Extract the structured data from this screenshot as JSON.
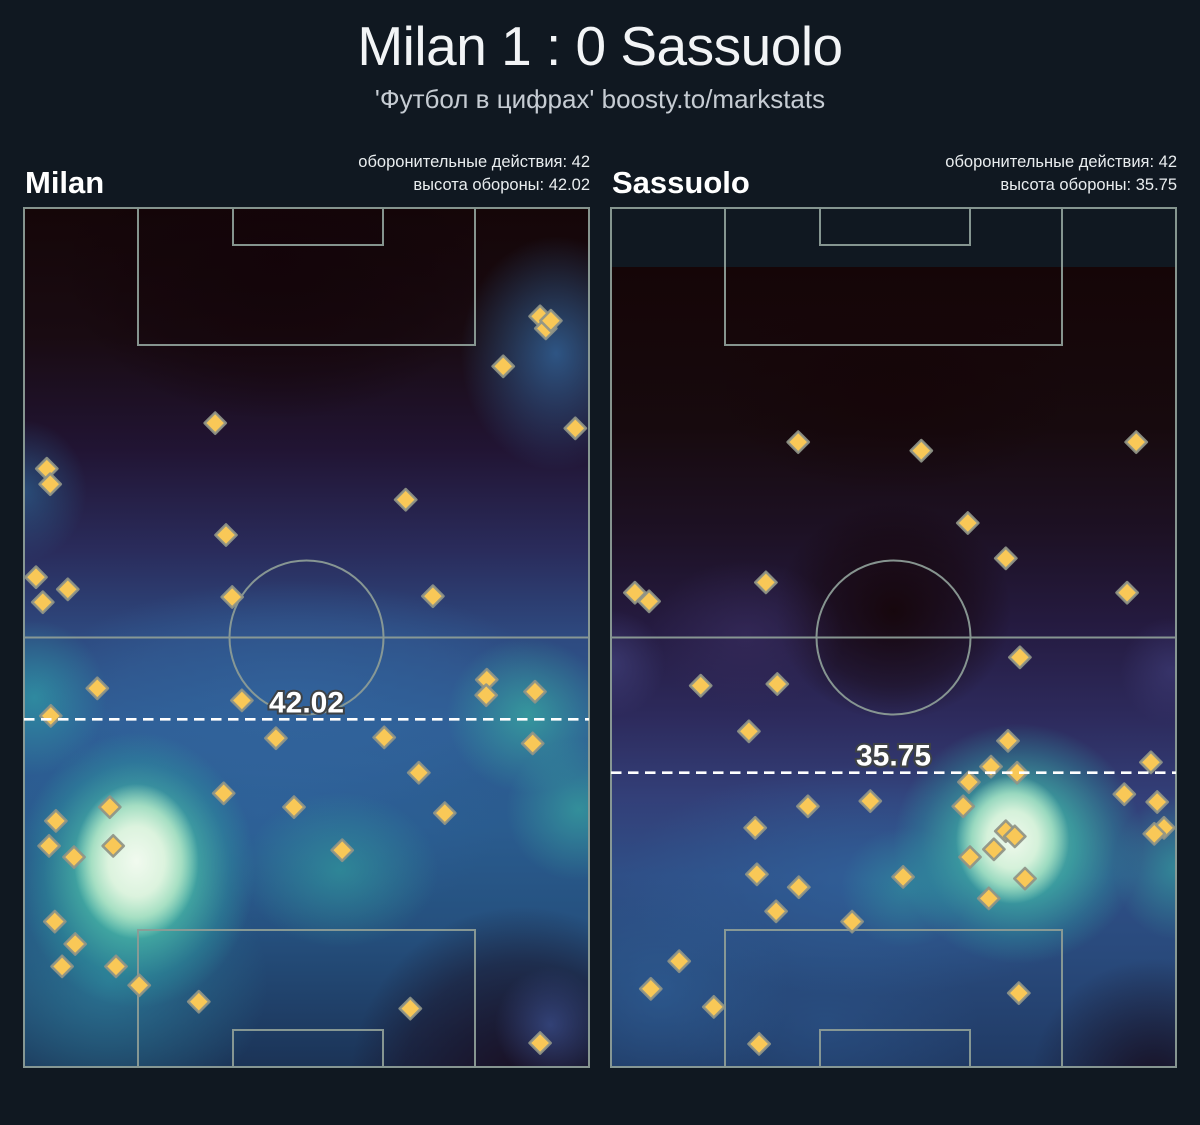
{
  "page": {
    "background": "#101821",
    "title": "Milan 1 : 0 Sassuolo",
    "subtitle": "'Футбол в цифрах' boosty.to/markstats"
  },
  "style": {
    "line_color": "#8c9c96",
    "marker_fill": "#f9c857",
    "marker_stroke": "#8e9488",
    "dash_color": "#ffffff",
    "label_fill": "#ffffff",
    "label_outline": "#3e4245",
    "title_color": "#f2f4f6",
    "subtitle_color": "#c6ccd3",
    "stat_text_color": "#e9edef"
  },
  "chart_data": {
    "type": "scatter",
    "overlay": "kde-heatmap",
    "title": "Milan 1 : 0 Sassuolo",
    "subtitle": "'Футбол в цифрах' boosty.to/markstats",
    "units": "marker coords are percent of pitch box; x: 0=left touchline, 100=right; y: 0=attacking goal line, 100=own goal line",
    "pitch_geometry": {
      "width_px": 567,
      "height_px": 861,
      "penalty_box": {
        "x": 115,
        "w": 337,
        "d": 137
      },
      "goal_box": {
        "x": 210,
        "w": 150,
        "d": 37
      },
      "circle_r": 77
    },
    "pitches": [
      {
        "team": "Milan",
        "defensive_actions": 42,
        "defense_height": 42.02,
        "stat1": "оборонительные действия: 42",
        "stat2": "высота обороны: 42.02",
        "defense_line_label": "42.02",
        "defense_line_y_pct": 59.5,
        "heat_top_px": 0,
        "markers_pct": [
          [
            91.2,
            12.7
          ],
          [
            92.2,
            14.1
          ],
          [
            93.1,
            13.2
          ],
          [
            84.7,
            18.5
          ],
          [
            33.9,
            25.1
          ],
          [
            97.4,
            25.7
          ],
          [
            4.2,
            30.4
          ],
          [
            4.8,
            32.2
          ],
          [
            67.5,
            34.0
          ],
          [
            35.8,
            38.1
          ],
          [
            2.3,
            43.0
          ],
          [
            7.9,
            44.4
          ],
          [
            3.5,
            45.9
          ],
          [
            36.9,
            45.3
          ],
          [
            72.3,
            45.2
          ],
          [
            13.1,
            55.9
          ],
          [
            81.8,
            54.9
          ],
          [
            81.7,
            56.7
          ],
          [
            90.3,
            56.3
          ],
          [
            38.6,
            57.3
          ],
          [
            4.9,
            59.1
          ],
          [
            44.6,
            61.7
          ],
          [
            63.7,
            61.6
          ],
          [
            89.9,
            62.3
          ],
          [
            69.8,
            65.7
          ],
          [
            15.3,
            69.7
          ],
          [
            5.8,
            71.3
          ],
          [
            4.6,
            74.2
          ],
          [
            9.0,
            75.5
          ],
          [
            15.9,
            74.2
          ],
          [
            35.4,
            68.1
          ],
          [
            47.8,
            69.7
          ],
          [
            56.3,
            74.7
          ],
          [
            74.4,
            70.4
          ],
          [
            5.6,
            83.0
          ],
          [
            9.2,
            85.6
          ],
          [
            6.9,
            88.2
          ],
          [
            16.4,
            88.2
          ],
          [
            20.5,
            90.4
          ],
          [
            31.0,
            92.3
          ],
          [
            68.3,
            93.1
          ],
          [
            91.2,
            97.1
          ]
        ],
        "heat": {
          "base": [
            "#150608 0%",
            "#190b12 15%",
            "#211433 28%",
            "#2a2c5c 40%",
            "#2e4a80 50%",
            "#2e5d94 60%",
            "#2a5c8f 72%",
            "#25507e 84%",
            "#1f3e66 94%",
            "#1b3356 100%"
          ],
          "blobs": [
            {
              "size": "11% 9%",
              "at": "20% 76%",
              "stops": [
                "#f1faef 0%",
                "#dcf3de 45%",
                "#b5e7c8d9 72%",
                "#b5e7c800 100%"
              ]
            },
            {
              "size": "21% 16%",
              "at": "20% 77%",
              "stops": [
                "#8edcba 0%",
                "#4abca8cc 45%",
                "#2f9aa066 78%",
                "#2f9aa000 100%"
              ]
            },
            {
              "size": "17% 12%",
              "at": "2% 57%",
              "stops": [
                "#2f96a4cc 0%",
                "#2f96a400 75%"
              ]
            },
            {
              "size": "36% 21%",
              "at": "15% 90%",
              "stops": [
                "#2e86a0b3 0%",
                "#2e86a000 78%"
              ]
            },
            {
              "size": "23% 12%",
              "at": "56% 77%",
              "stops": [
                "#30989bb3 0%",
                "#30989b00 75%"
              ]
            },
            {
              "size": "19% 12%",
              "at": "89% 59%",
              "stops": [
                "#38aaa0bf 0%",
                "#38aaa000 75%"
              ]
            },
            {
              "size": "17% 11%",
              "at": "98% 70%",
              "stops": [
                "#38aaa0a6 0%",
                "#38aaa000 75%"
              ]
            },
            {
              "size": "21% 17%",
              "at": "94% 17%",
              "stops": [
                "#33679fcc 0%",
                "#33679f00 80%"
              ]
            },
            {
              "size": "15% 11%",
              "at": "0% 33%",
              "stops": [
                "#2d6d9c99 0%",
                "#2d6d9c00 75%"
              ]
            },
            {
              "size": "55% 16%",
              "at": "48% 57%",
              "stops": [
                "#33669fb3 0%",
                "#33669f59 55%",
                "#33669f00 85%"
              ]
            },
            {
              "size": "50% 18%",
              "at": "42% 70%",
              "stops": [
                "#2f639bb3 0%",
                "#2f639b00 85%"
              ]
            },
            {
              "size": "13% 9%",
              "at": "93% 95%",
              "stops": [
                "#3c5191b3 0%",
                "#3c519100 75%"
              ]
            },
            {
              "size": "38% 26%",
              "at": "88% 102%",
              "stops": [
                "#190d20f2 0%",
                "#190d2073 55%",
                "#190d2000 80%"
              ]
            },
            {
              "size": "45% 22%",
              "at": "45% 6%",
              "stops": [
                "#130409e6 0%",
                "#13040966 60%",
                "#13040900 85%"
              ]
            }
          ]
        }
      },
      {
        "team": "Sassuolo",
        "defensive_actions": 42,
        "defense_height": 35.75,
        "stat1": "оборонительные действия: 42",
        "stat2": "высота обороны: 35.75",
        "defense_line_label": "35.75",
        "defense_line_y_pct": 65.7,
        "heat_top_px": 60,
        "markers_pct": [
          [
            33.2,
            27.3
          ],
          [
            54.9,
            28.3
          ],
          [
            92.8,
            27.3
          ],
          [
            63.1,
            36.7
          ],
          [
            69.8,
            40.8
          ],
          [
            27.5,
            43.6
          ],
          [
            4.4,
            44.8
          ],
          [
            6.9,
            45.8
          ],
          [
            91.2,
            44.8
          ],
          [
            72.3,
            52.3
          ],
          [
            16.0,
            55.6
          ],
          [
            29.5,
            55.4
          ],
          [
            24.5,
            60.9
          ],
          [
            70.2,
            62.0
          ],
          [
            67.2,
            65.0
          ],
          [
            71.8,
            65.7
          ],
          [
            63.3,
            66.8
          ],
          [
            95.4,
            64.5
          ],
          [
            90.7,
            68.2
          ],
          [
            96.5,
            69.1
          ],
          [
            97.7,
            72.1
          ],
          [
            96.0,
            72.8
          ],
          [
            62.3,
            69.6
          ],
          [
            69.8,
            72.5
          ],
          [
            71.4,
            73.1
          ],
          [
            67.7,
            74.6
          ],
          [
            63.5,
            75.5
          ],
          [
            66.8,
            80.3
          ],
          [
            73.2,
            78.0
          ],
          [
            34.9,
            69.6
          ],
          [
            45.9,
            69.0
          ],
          [
            25.6,
            72.1
          ],
          [
            51.7,
            77.8
          ],
          [
            25.9,
            77.5
          ],
          [
            33.3,
            79.0
          ],
          [
            29.3,
            81.8
          ],
          [
            42.7,
            83.0
          ],
          [
            12.2,
            87.6
          ],
          [
            7.2,
            90.8
          ],
          [
            18.3,
            92.9
          ],
          [
            26.3,
            97.2
          ],
          [
            72.1,
            91.3
          ]
        ],
        "heat": {
          "base": [
            "#150507 0%",
            "#170a0e 20%",
            "#1d1124 33%",
            "#251b41 45%",
            "#2d2a5c 56%",
            "#333f78 66%",
            "#2f4f87 76%",
            "#294a7c 86%",
            "#203a64 100%"
          ],
          "blobs": [
            {
              "size": "10% 8%",
              "at": "71% 71.5%",
              "stops": [
                "#f0f9ec 0%",
                "#d5f1da 45%",
                "#a8e3c5d9 72%",
                "#a8e3c500 100%"
              ]
            },
            {
              "size": "22% 15%",
              "at": "72% 72%",
              "stops": [
                "#80d5b3d9 0%",
                "#3fb3a6bf 45%",
                "#2f9aa059 78%",
                "#2f9aa000 100%"
              ]
            },
            {
              "size": "15% 12%",
              "at": "100% 75%",
              "stops": [
                "#35a09fb3 0%",
                "#35a09f00 75%"
              ]
            },
            {
              "size": "15% 10%",
              "at": "52% 77.5%",
              "stops": [
                "#309a9f8c 0%",
                "#309a9f00 75%"
              ]
            },
            {
              "size": "52% 17%",
              "at": "46% 76.5%",
              "stops": [
                "#30639cbf 0%",
                "#30639c00 85%"
              ]
            },
            {
              "size": "28% 18%",
              "at": "9% 90.5%",
              "stops": [
                "#2e5e95b3 0%",
                "#2e5e9500 80%"
              ]
            },
            {
              "size": "33% 16%",
              "at": "38% 94.5%",
              "stops": [
                "#2b53889e 0%",
                "#2b538800 82%"
              ]
            },
            {
              "size": "13% 9%",
              "at": "0% 49.5%",
              "stops": [
                "#41417cb3 0%",
                "#41417c00 75%"
              ]
            },
            {
              "size": "22% 12%",
              "at": "24% 46%",
              "stops": [
                "#3a2f6299 0%",
                "#3a2f6200 78%"
              ]
            },
            {
              "size": "12% 9%",
              "at": "99% 50.5%",
              "stops": [
                "#3e3c77a6 0%",
                "#3e3c7700 75%"
              ]
            },
            {
              "size": "26% 17%",
              "at": "50% 43%",
              "stops": [
                "#150508e6 0%",
                "#15050866 55%",
                "#15050800 80%"
              ]
            },
            {
              "size": "28% 20%",
              "at": "96% 102%",
              "stops": [
                "#170c1de6 0%",
                "#170c1d00 78%"
              ]
            },
            {
              "size": "40% 18%",
              "at": "50% 14%",
              "stops": [
                "#150508d9 0%",
                "#15050800 80%"
              ]
            }
          ]
        }
      }
    ]
  }
}
